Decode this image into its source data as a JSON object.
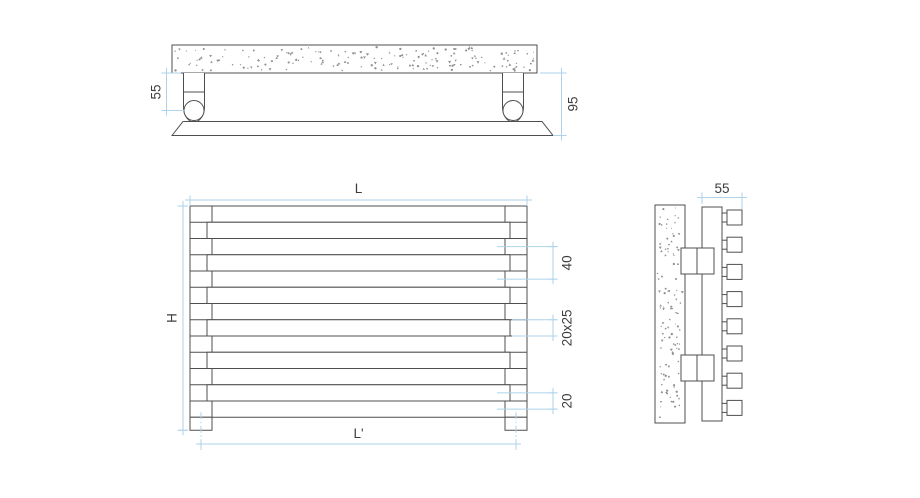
{
  "colors": {
    "line": "#4f4f4f",
    "dimension": "#aed2ea",
    "dimension_text": "#3d3d3d",
    "speckle": "#8f8f8f",
    "background": "#ffffff"
  },
  "views": {
    "top": {
      "name": "top view - wall section with brackets and radiator panel",
      "brackets": 2,
      "dims": {
        "bracket_offset": "55",
        "total_depth": "95"
      }
    },
    "front": {
      "name": "front view - horizontal tube radiator",
      "tube_rows": 13,
      "dims": {
        "width": "L",
        "height": "H",
        "connection_width": "L'",
        "tube_pitch": "40",
        "tube_section": "20x25",
        "connection_offset": "20"
      }
    },
    "side": {
      "name": "side view - wall, brackets, collector and tube ends",
      "tube_stubs": 8,
      "brackets": 2,
      "dims": {
        "depth": "55"
      }
    }
  }
}
